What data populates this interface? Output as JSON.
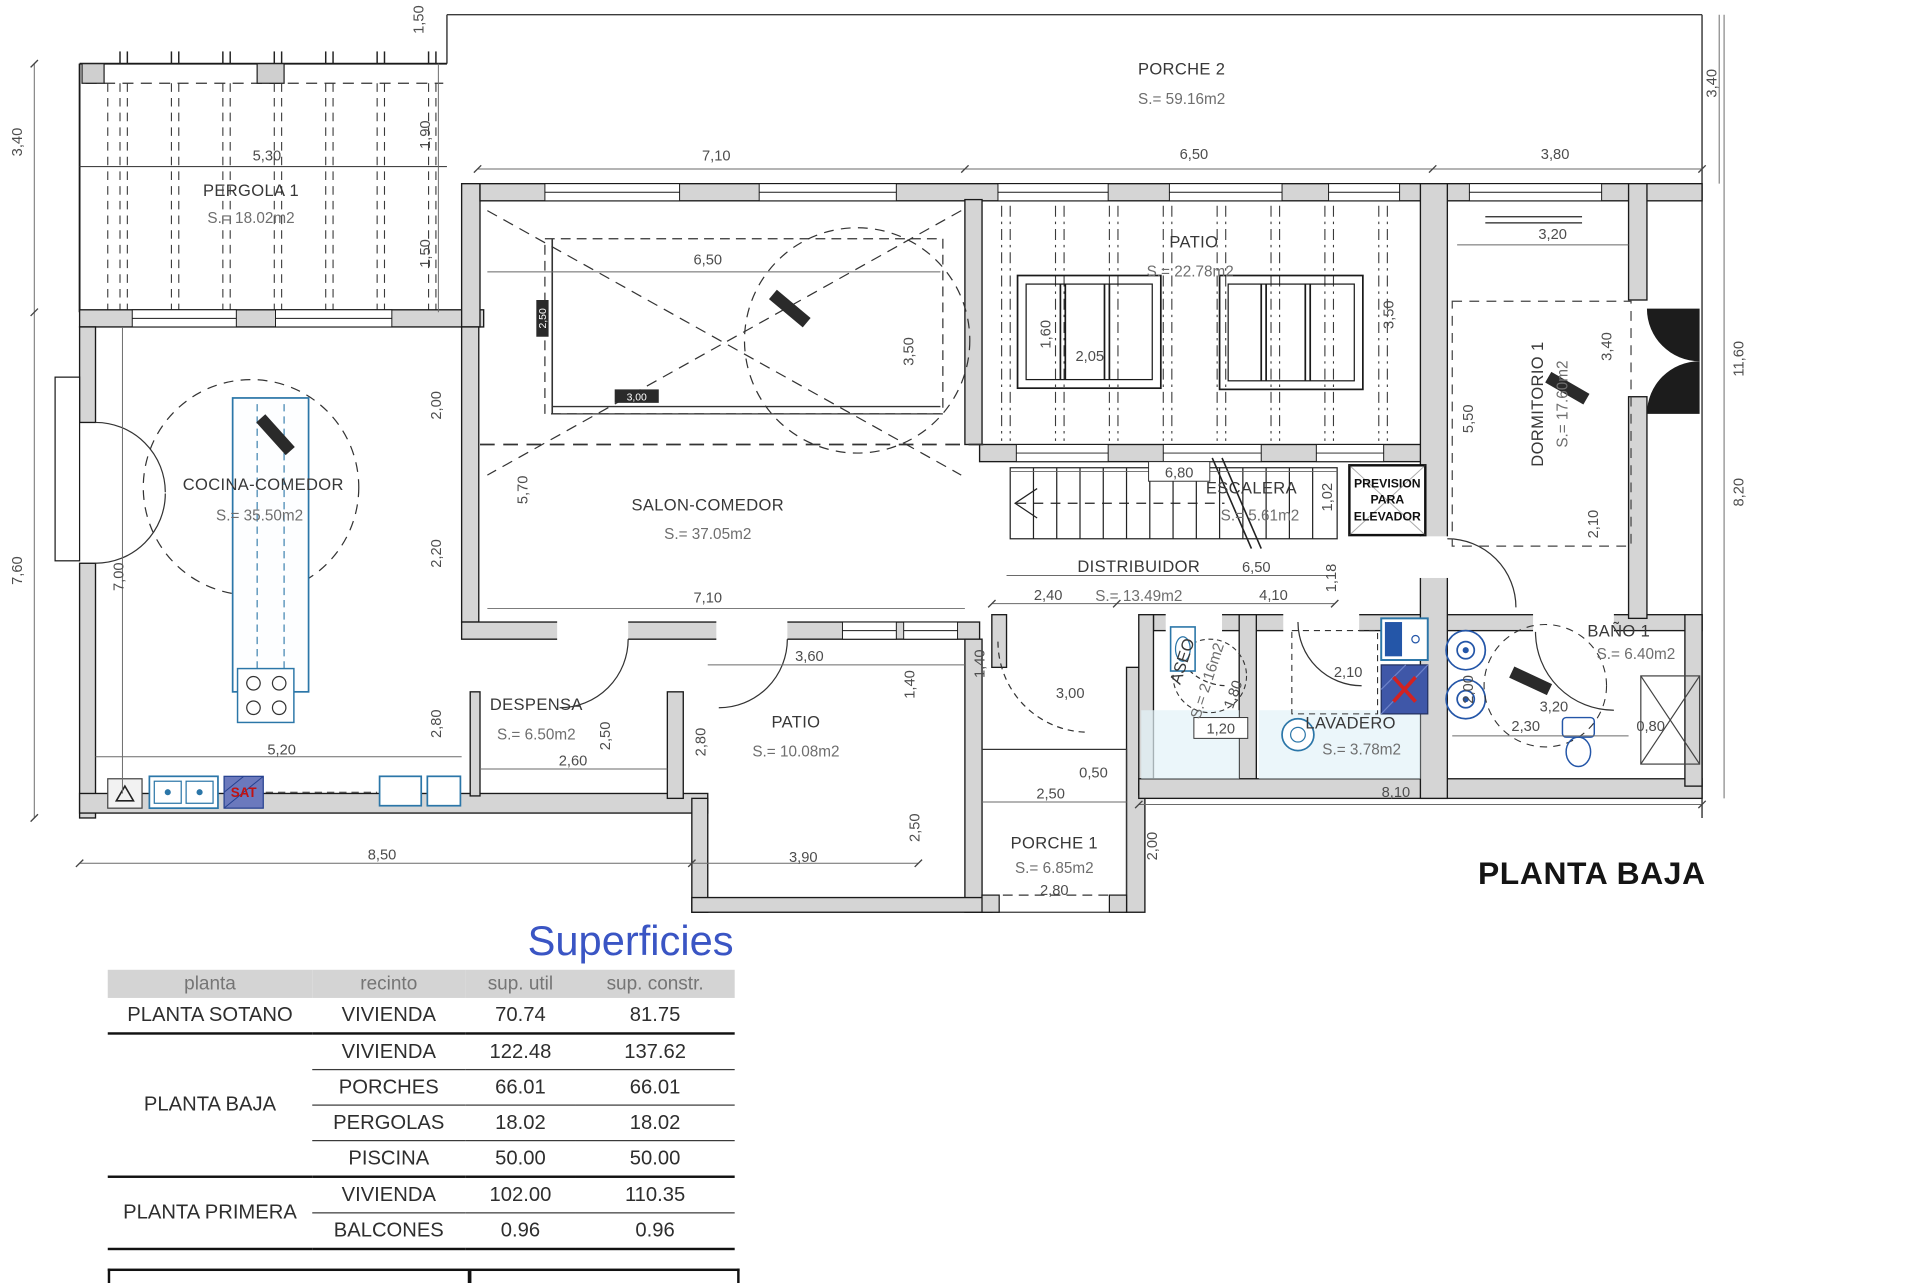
{
  "plan": {
    "floor_title": "PLANTA BAJA",
    "rooms": {
      "pergola1": {
        "name": "PERGOLA 1",
        "area": "S.= 18.02m2"
      },
      "porche2": {
        "name": "PORCHE 2",
        "area": "S.= 59.16m2"
      },
      "patio_top": {
        "name": "PATIO",
        "area": "S.= 22.78m2"
      },
      "dormitorio1": {
        "name": "DORMITORIO 1",
        "area": "S.= 17.60m2"
      },
      "cocina": {
        "name": "COCINA-COMEDOR",
        "area": "S.= 35.50m2"
      },
      "salon": {
        "name": "SALON-COMEDOR",
        "area": "S.= 37.05m2"
      },
      "escalera": {
        "name": "ESCALERA",
        "area": "S.= 5.61m2"
      },
      "distribuidor": {
        "name": "DISTRIBUIDOR",
        "area": "S.= 13.49m2"
      },
      "despensa": {
        "name": "DESPENSA",
        "area": "S.= 6.50m2"
      },
      "patio_small": {
        "name": "PATIO",
        "area": "S.= 10.08m2"
      },
      "aseo": {
        "name": "ASEO",
        "area": "S.= 2.16m2"
      },
      "lavadero": {
        "name": "LAVADERO",
        "area": "S.= 3.78m2"
      },
      "bano1": {
        "name": "BAÑO 1",
        "area": "S.= 6.40m2"
      },
      "porche1": {
        "name": "PORCHE 1",
        "area": "S.= 6.85m2"
      }
    },
    "elevator_note": [
      "PREVISION",
      "PARA",
      "ELEVADOR"
    ],
    "labels": {
      "sat": "SAT"
    },
    "chips": [
      "2,50",
      "3,00"
    ],
    "dims": [
      "1,50",
      "3,40",
      "5,30",
      "1,90",
      "1,50",
      "7,10",
      "6,50",
      "3,80",
      "3,40",
      "3,20",
      "6,50",
      "3,50",
      "1,60",
      "2,05",
      "3,50",
      "3,40",
      "11,60",
      "5,50",
      "8,20",
      "2,00",
      "2,20",
      "5,70",
      "7,60",
      "7,00",
      "2,10",
      "6,80",
      "1,02",
      "6,50",
      "4,10",
      "1,18",
      "2,40",
      "7,10",
      "3,60",
      "1,40",
      "1,40",
      "3,00",
      "1,80",
      "1,20",
      "2,10",
      "2,00",
      "3,20",
      "2,30",
      "0,80",
      "8,10",
      "2,50",
      "0,50",
      "2,80",
      "2,50",
      "2,60",
      "2,80",
      "5,20",
      "8,50",
      "3,90",
      "2,50",
      "2,00",
      "2,80"
    ]
  },
  "table": {
    "title": "Superficies",
    "headers": [
      "planta",
      "recinto",
      "sup. util",
      "sup. constr."
    ],
    "groups": [
      {
        "planta": "PLANTA SOTANO",
        "rows": [
          [
            "VIVIENDA",
            "70.74",
            "81.75"
          ]
        ]
      },
      {
        "planta": "PLANTA BAJA",
        "rows": [
          [
            "VIVIENDA",
            "122.48",
            "137.62"
          ],
          [
            "PORCHES",
            "66.01",
            "66.01"
          ],
          [
            "PERGOLAS",
            "18.02",
            "18.02"
          ],
          [
            "PISCINA",
            "50.00",
            "50.00"
          ]
        ]
      },
      {
        "planta": "PLANTA PRIMERA",
        "rows": [
          [
            "VIVIENDA",
            "102.00",
            "110.35"
          ],
          [
            "BALCONES",
            "0.96",
            "0.96"
          ]
        ]
      }
    ]
  }
}
